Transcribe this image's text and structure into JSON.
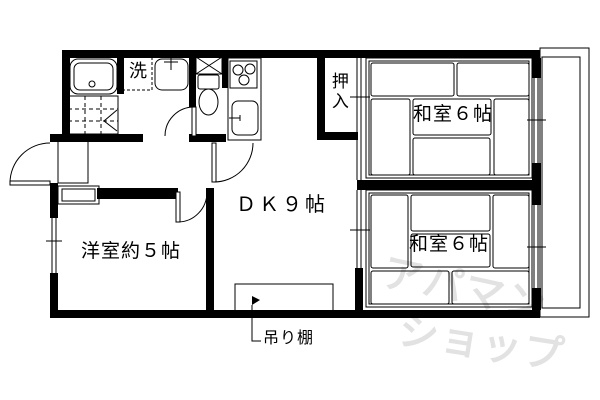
{
  "floorplan": {
    "labels": {
      "dk": "ＤＫ９帖",
      "washitsu_top": "和室６帖",
      "washitsu_bottom": "和室６帖",
      "yoshitsu": "洋室約５帖",
      "oshiire": "押入",
      "laundry": "洗",
      "tsuridana": "吊り棚"
    },
    "watermark": {
      "line1": "アパマン",
      "line2": "ショップ"
    },
    "colors": {
      "line": "#000000",
      "background": "#ffffff",
      "watermark": "#e2e2e2"
    }
  }
}
